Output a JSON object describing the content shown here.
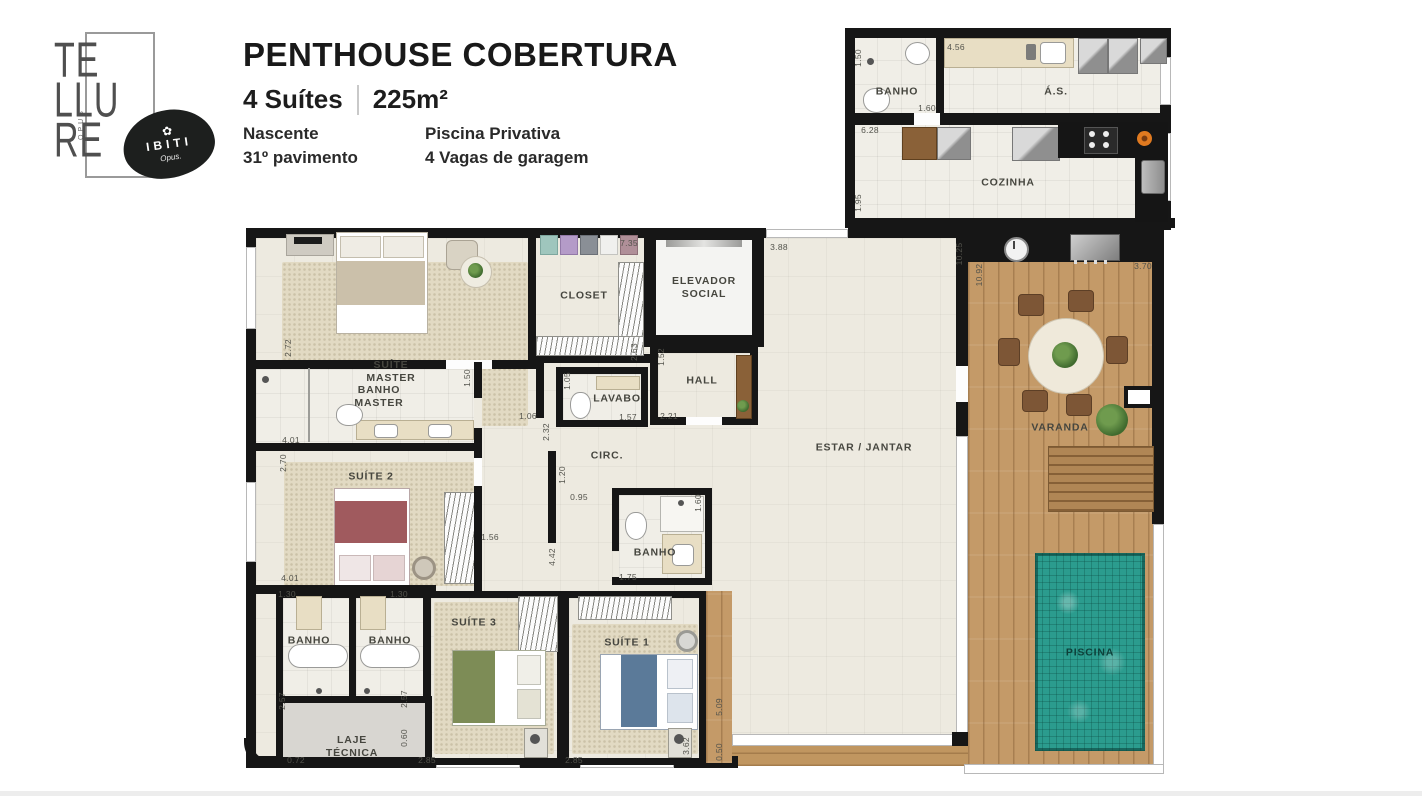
{
  "header": {
    "logo": {
      "brand_lines": [
        "TE",
        "LLU",
        "RE"
      ],
      "brand_vertical": "OPUS",
      "badge_flower": "✿",
      "badge_title": "IBITI",
      "badge_subtitle": "Opus."
    },
    "title": "PENTHOUSE COBERTURA",
    "suites": "4 Suítes",
    "area": "225m²",
    "features": [
      {
        "label": "Nascente"
      },
      {
        "label": "31º pavimento"
      },
      {
        "label": "Piscina Privativa"
      },
      {
        "label": "4 Vagas de garagem"
      }
    ]
  },
  "plan": {
    "colors": {
      "wall": "#161616",
      "wood_deck": "#c49a68",
      "pool_water": "#2b9c8e",
      "floor": "#edeae0"
    },
    "rooms": [
      {
        "id": "banho-servico",
        "label": "BANHO",
        "x": 897,
        "y": 92
      },
      {
        "id": "area-servico",
        "label": "Á.S.",
        "x": 1056,
        "y": 92
      },
      {
        "id": "cozinha",
        "label": "COZINHA",
        "x": 1008,
        "y": 183
      },
      {
        "id": "suite-master",
        "label": "SUÍTE\nMASTER",
        "x": 391,
        "y": 372
      },
      {
        "id": "closet",
        "label": "CLOSET",
        "x": 584,
        "y": 296
      },
      {
        "id": "elevador-social",
        "label": "ELEVADOR\nSOCIAL",
        "x": 704,
        "y": 288
      },
      {
        "id": "hall",
        "label": "HALL",
        "x": 702,
        "y": 381
      },
      {
        "id": "lavabo",
        "label": "LAVABO",
        "x": 617,
        "y": 399
      },
      {
        "id": "banho-master",
        "label": "BANHO\nMASTER",
        "x": 379,
        "y": 397
      },
      {
        "id": "circulacao",
        "label": "CIRC.",
        "x": 607,
        "y": 456
      },
      {
        "id": "estar-jantar",
        "label": "ESTAR / JANTAR",
        "x": 864,
        "y": 448
      },
      {
        "id": "varanda",
        "label": "VARANDA",
        "x": 1060,
        "y": 428
      },
      {
        "id": "suite-2",
        "label": "SUÍTE 2",
        "x": 371,
        "y": 477
      },
      {
        "id": "banho-suites",
        "label": "BANHO",
        "x": 655,
        "y": 553
      },
      {
        "id": "suite-3",
        "label": "SUÍTE 3",
        "x": 474,
        "y": 623
      },
      {
        "id": "suite-1",
        "label": "SUÍTE 1",
        "x": 627,
        "y": 643
      },
      {
        "id": "banho-esquerdo",
        "label": "BANHO",
        "x": 309,
        "y": 641
      },
      {
        "id": "banho-direito",
        "label": "BANHO",
        "x": 390,
        "y": 641
      },
      {
        "id": "laje-tecnica",
        "label": "LAJE\nTÉCNICA",
        "x": 352,
        "y": 747
      },
      {
        "id": "piscina",
        "label": "PISCINA",
        "x": 1090,
        "y": 653
      }
    ],
    "dimensions": [
      {
        "v": "1.50",
        "x": 858,
        "y": 58,
        "vert": true
      },
      {
        "v": "4.56",
        "x": 956,
        "y": 47,
        "vert": false
      },
      {
        "v": "1.60",
        "x": 927,
        "y": 108,
        "vert": false
      },
      {
        "v": "6.28",
        "x": 870,
        "y": 130,
        "vert": false
      },
      {
        "v": "1.95",
        "x": 858,
        "y": 203,
        "vert": true
      },
      {
        "v": "7.35",
        "x": 629,
        "y": 243,
        "vert": false
      },
      {
        "v": "3.88",
        "x": 779,
        "y": 247,
        "vert": false
      },
      {
        "v": "10.25",
        "x": 959,
        "y": 254,
        "vert": true
      },
      {
        "v": "10.92",
        "x": 979,
        "y": 275,
        "vert": true
      },
      {
        "v": "3.70",
        "x": 1143,
        "y": 266,
        "vert": false
      },
      {
        "v": "2.72",
        "x": 288,
        "y": 348,
        "vert": true
      },
      {
        "v": "2.63",
        "x": 634,
        "y": 352,
        "vert": true
      },
      {
        "v": "1.52",
        "x": 661,
        "y": 357,
        "vert": true
      },
      {
        "v": "1.05",
        "x": 567,
        "y": 381,
        "vert": true
      },
      {
        "v": "1.50",
        "x": 467,
        "y": 378,
        "vert": true
      },
      {
        "v": "1.06",
        "x": 528,
        "y": 416,
        "vert": false
      },
      {
        "v": "1.57",
        "x": 628,
        "y": 417,
        "vert": false
      },
      {
        "v": "2.21",
        "x": 669,
        "y": 416,
        "vert": false
      },
      {
        "v": "4.01",
        "x": 291,
        "y": 440,
        "vert": false
      },
      {
        "v": "2.32",
        "x": 546,
        "y": 432,
        "vert": true
      },
      {
        "v": "2.70",
        "x": 283,
        "y": 463,
        "vert": true
      },
      {
        "v": "1.20",
        "x": 562,
        "y": 475,
        "vert": true
      },
      {
        "v": "0.95",
        "x": 579,
        "y": 497,
        "vert": false
      },
      {
        "v": "1.56",
        "x": 490,
        "y": 537,
        "vert": false
      },
      {
        "v": "4.42",
        "x": 552,
        "y": 557,
        "vert": true
      },
      {
        "v": "1.60",
        "x": 698,
        "y": 503,
        "vert": true
      },
      {
        "v": "4.01",
        "x": 290,
        "y": 578,
        "vert": false
      },
      {
        "v": "1.30",
        "x": 287,
        "y": 594,
        "vert": false
      },
      {
        "v": "1.30",
        "x": 399,
        "y": 594,
        "vert": false
      },
      {
        "v": "1.75",
        "x": 628,
        "y": 577,
        "vert": false
      },
      {
        "v": "2.57",
        "x": 282,
        "y": 701,
        "vert": true
      },
      {
        "v": "2.57",
        "x": 404,
        "y": 699,
        "vert": true
      },
      {
        "v": "0.60",
        "x": 404,
        "y": 738,
        "vert": true
      },
      {
        "v": "0.72",
        "x": 296,
        "y": 760,
        "vert": false
      },
      {
        "v": "2.85",
        "x": 427,
        "y": 760,
        "vert": false
      },
      {
        "v": "2.85",
        "x": 574,
        "y": 760,
        "vert": false
      },
      {
        "v": "3.62",
        "x": 686,
        "y": 746,
        "vert": true
      },
      {
        "v": "5.09",
        "x": 719,
        "y": 707,
        "vert": true
      },
      {
        "v": "0.50",
        "x": 719,
        "y": 752,
        "vert": true
      }
    ]
  }
}
